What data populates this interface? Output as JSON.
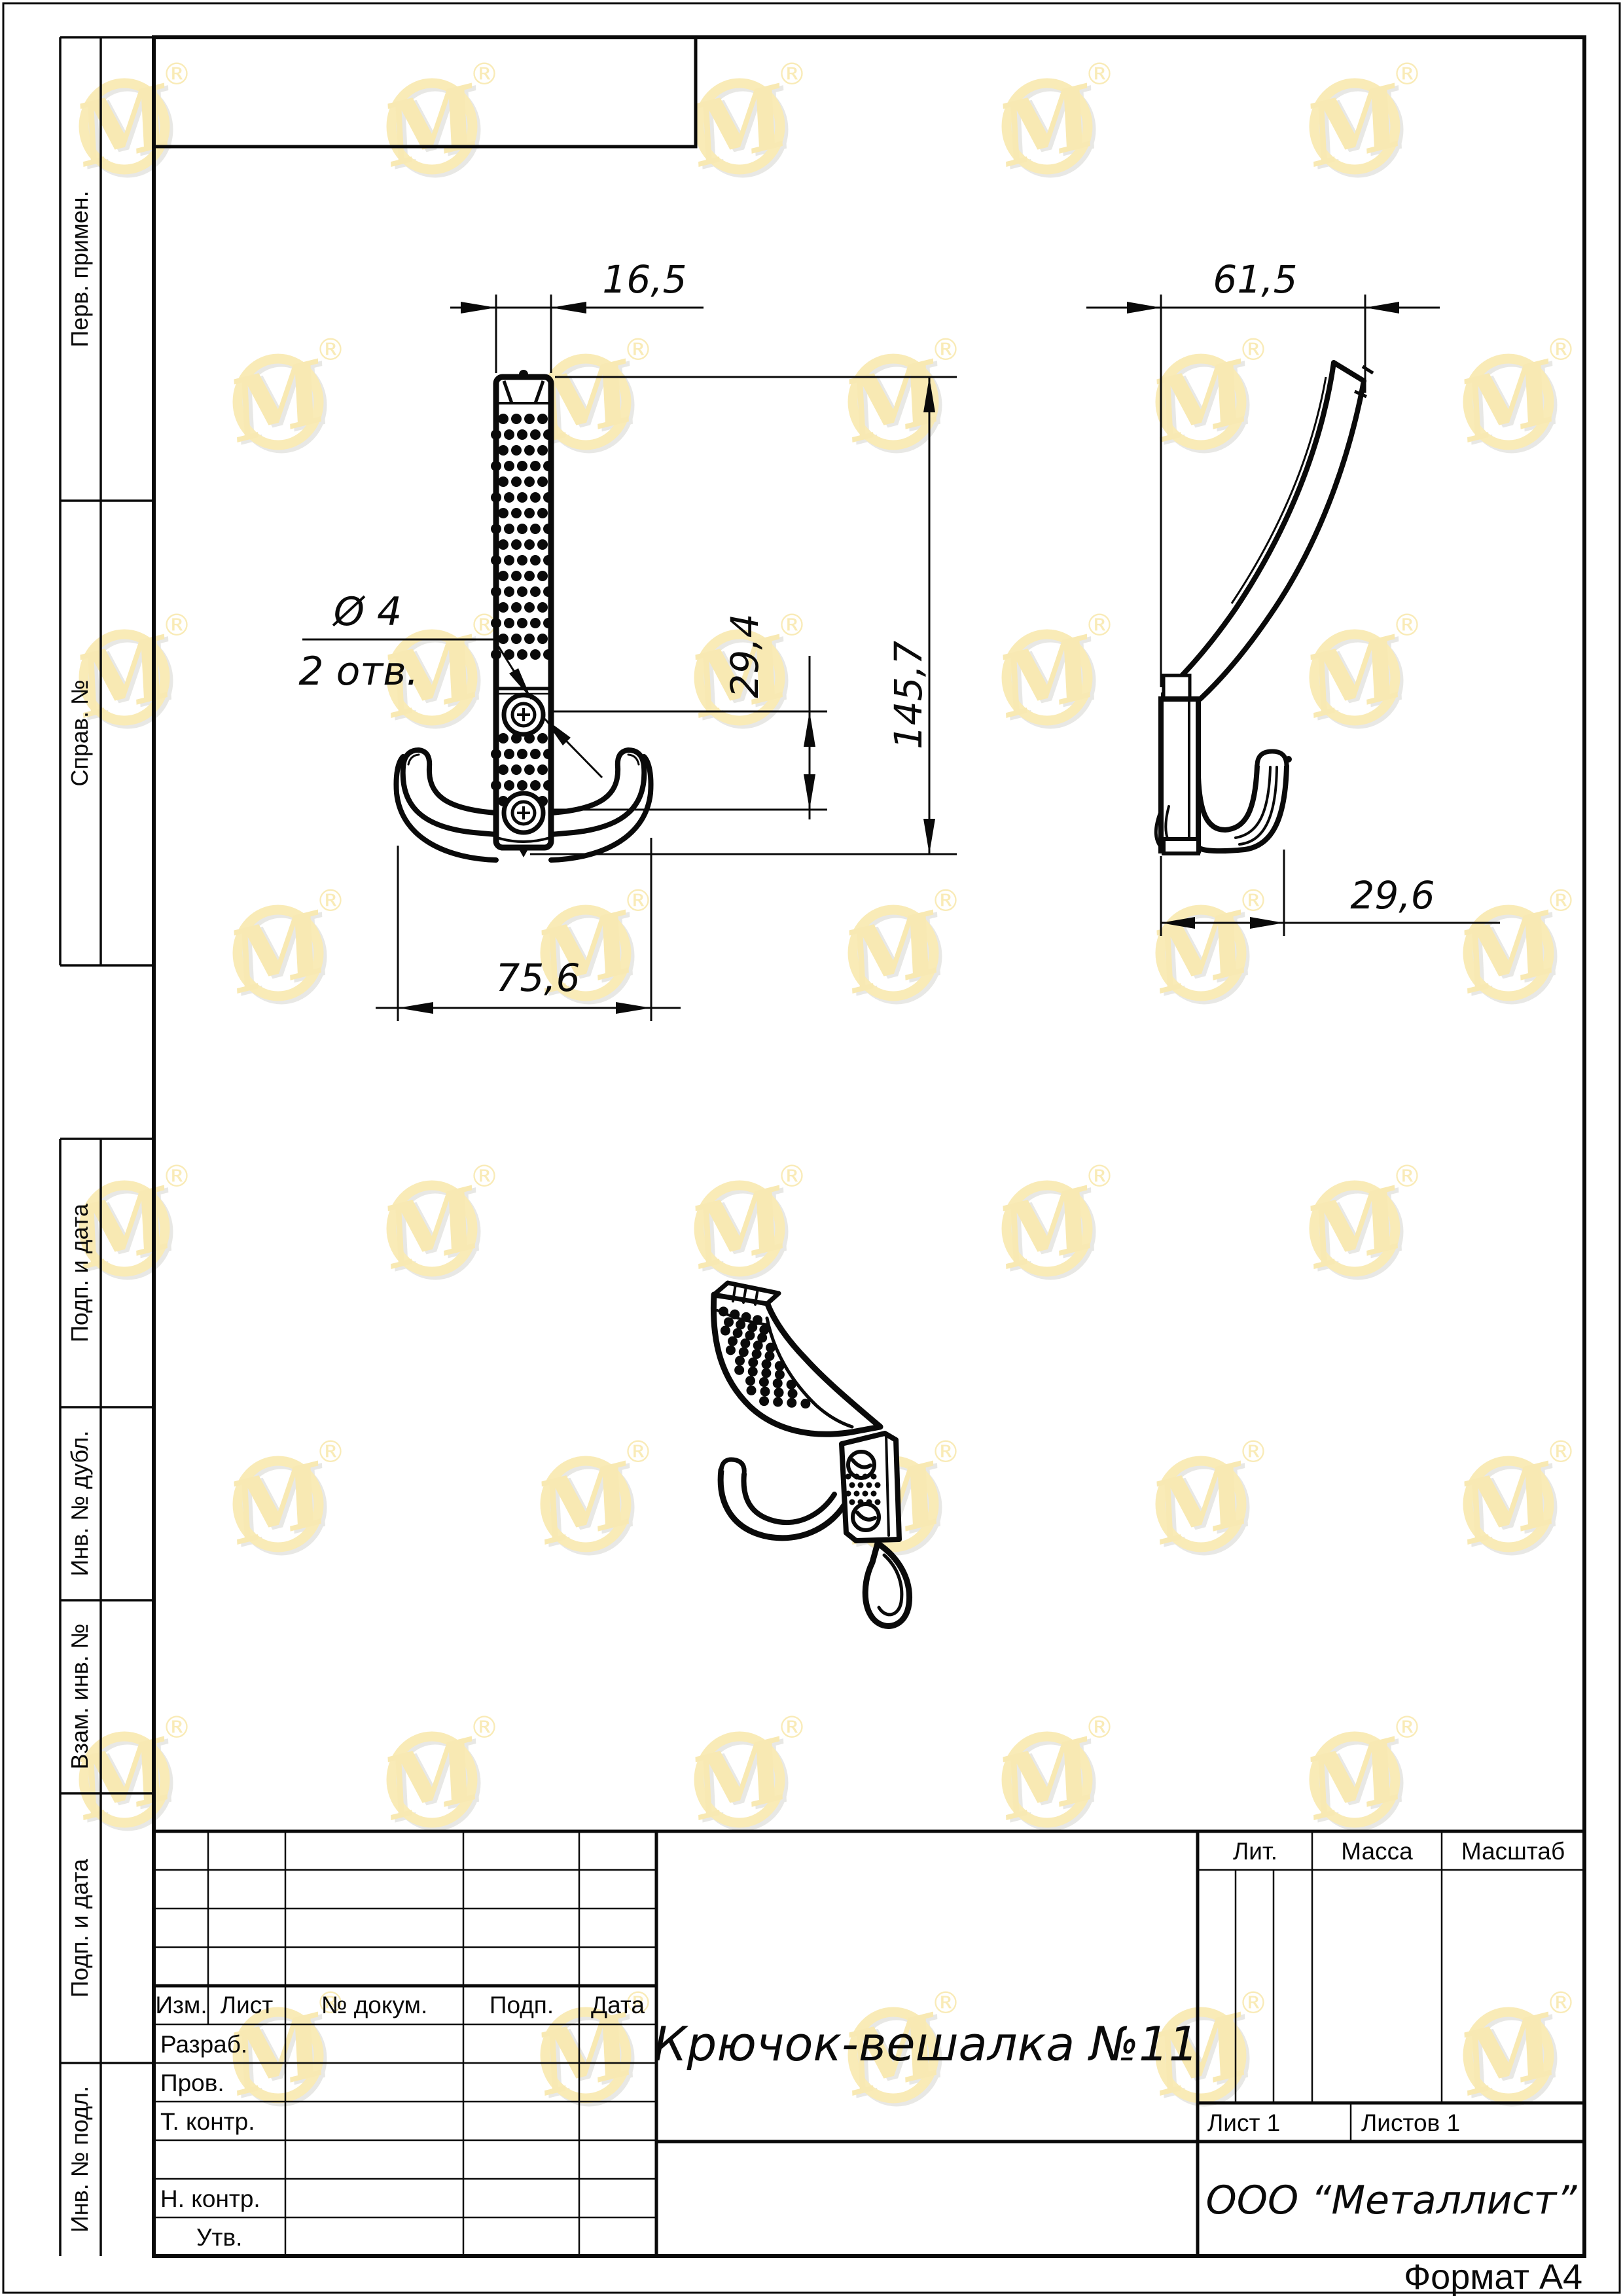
{
  "page": {
    "format_note": "Формат А4"
  },
  "margin_labels": {
    "items": [
      {
        "label": "Перв. примен."
      },
      {
        "label": "Справ. №"
      },
      {
        "label": "Подп. и дата"
      },
      {
        "label": "Инв. № дубл."
      },
      {
        "label": "Взам. инв. №"
      },
      {
        "label": "Подп. и дата"
      },
      {
        "label": "Инв. № подл."
      }
    ]
  },
  "title_block": {
    "doc_name": "Крючок-вешалка №11",
    "company": "ООО “Металлист”",
    "header": {
      "izm": "Изм.",
      "list": "Лист",
      "doc_no": "№ докум.",
      "sign": "Подп.",
      "date": "Дата"
    },
    "rows": {
      "razrab": "Разраб.",
      "prov": "Пров.",
      "t_kontr": "Т. контр.",
      "n_kontr": "Н. контр.",
      "utv": "Утв."
    },
    "lit_label": "Лит.",
    "mass_label": "Масса",
    "scale_label": "Масштаб",
    "sheet_value": "Лист 1",
    "sheets_value": "Листов 1"
  },
  "views": {
    "front": {
      "dims": {
        "width_top": "16,5",
        "height": "145,7",
        "hole_offset": "29,4",
        "width_bottom": "75,6",
        "hole_dia": "Ø 4",
        "hole_qty": "2 отв."
      }
    },
    "side": {
      "dims": {
        "depth": "61,5",
        "hook_depth": "29,6"
      }
    }
  },
  "watermark": {
    "glyph_char": "M",
    "reg_char": "®",
    "ring_color": "#f0cf55",
    "glyph_color": "#efcb4a",
    "shadow_color": "#c9c8c2"
  }
}
